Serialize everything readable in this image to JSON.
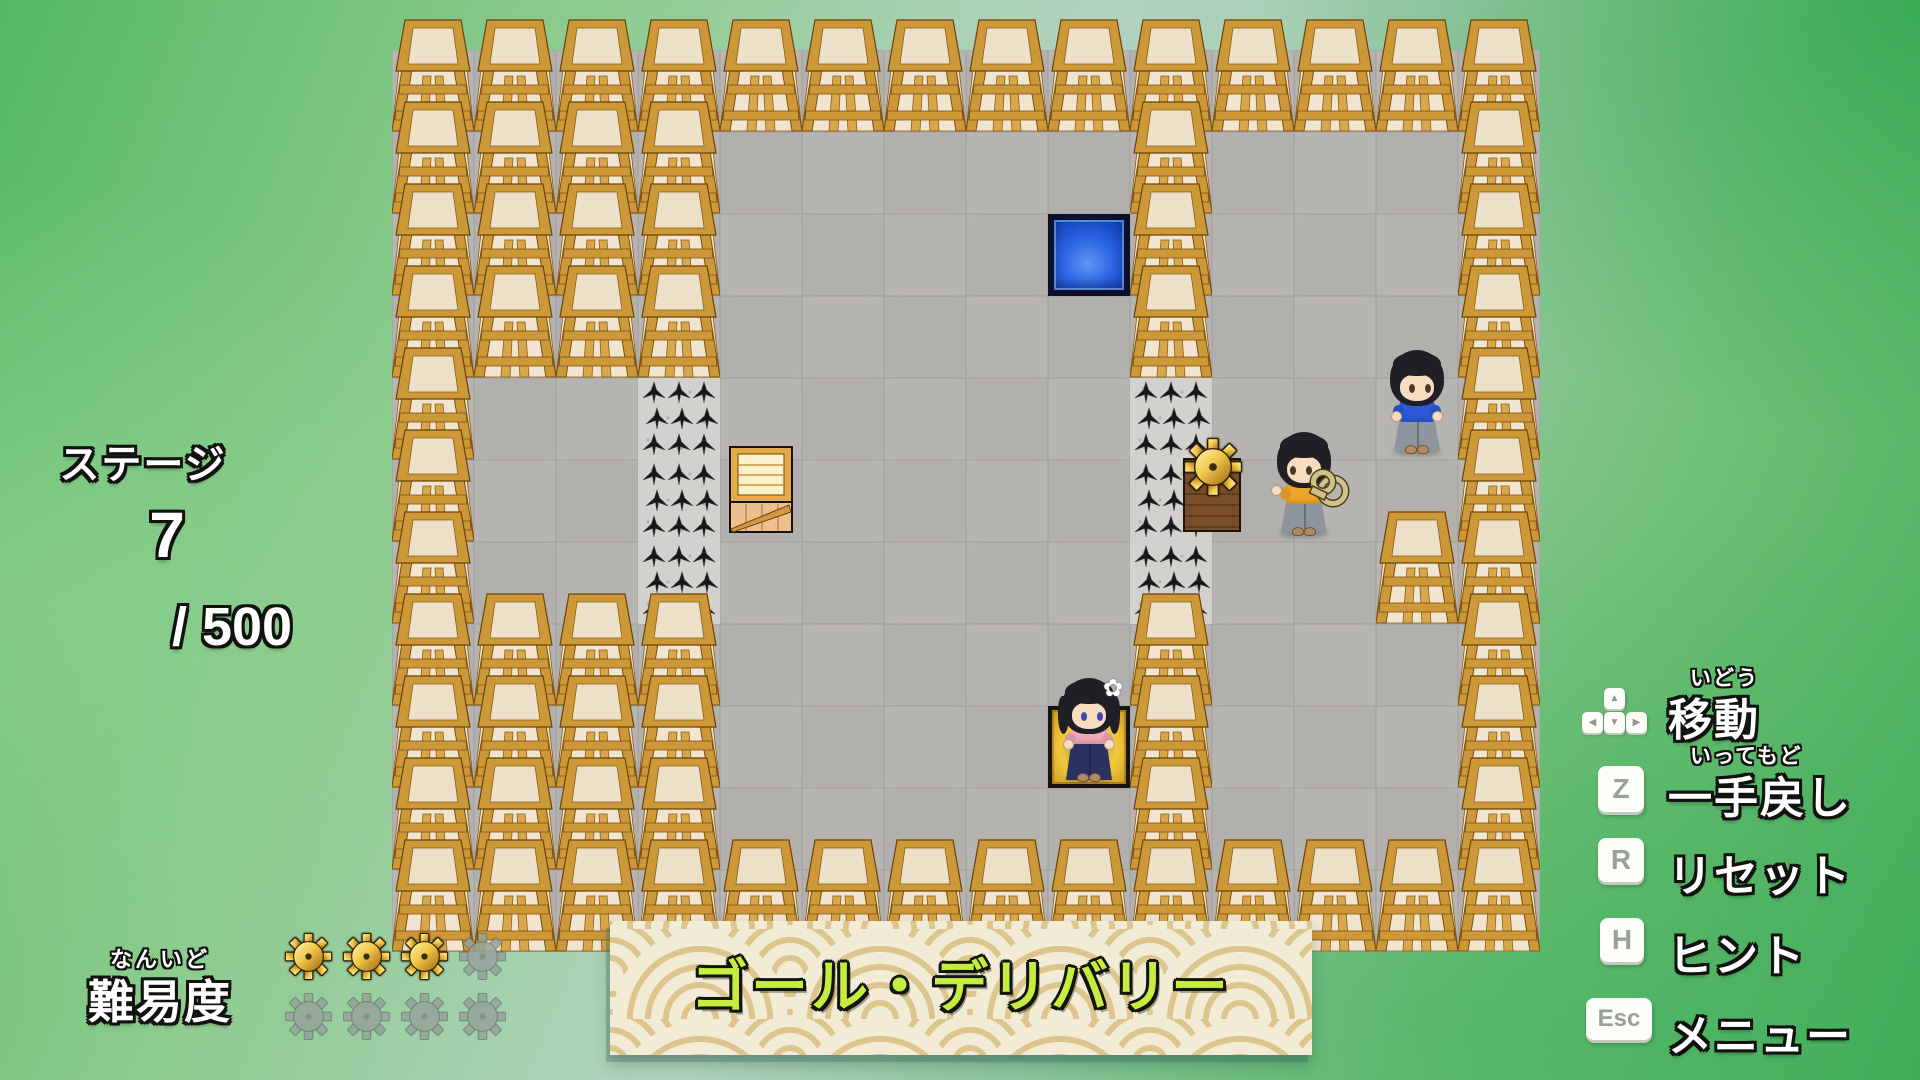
{
  "hud": {
    "stage": {
      "label": "ステージ",
      "number": "7",
      "total": "/ 500"
    },
    "difficulty": {
      "furigana": "なんいど",
      "label": "難易度",
      "filled": 3,
      "total": 8
    },
    "banner": {
      "title": "ゴール・デリバリー"
    }
  },
  "controls": {
    "move": {
      "furigana": "いどう",
      "label": "移動",
      "keys": [
        "▲",
        "◀",
        "▼",
        "▶"
      ]
    },
    "undo": {
      "furigana": "いってもど",
      "label": "一手戻し",
      "key": "Z"
    },
    "reset": {
      "label": "リセット",
      "key": "R"
    },
    "hint": {
      "label": "ヒント",
      "key": "H"
    },
    "menu": {
      "label": "メニュー",
      "key": "Esc"
    }
  },
  "board": {
    "origin_x": 392,
    "origin_y": 50,
    "tile": 82,
    "cols": 14,
    "rows": 11,
    "legend": {
      "W": "wall-block",
      "S": "spike-tile",
      ".": "stone-floor",
      "B": "blue-goal-tile",
      "G": "gold-goal-tile"
    },
    "map": [
      "WWWWWWWWWWWWWW",
      "WWWW.....W...W",
      "WWWW....BW...W",
      "WWWW.....W...W",
      "W..S.....S...W",
      "W..S.....S...W",
      "W..S.....S..WW",
      "WWWW.....W...W",
      "WWWW....GW...W",
      "WWWW.....W...W",
      "WWWWWWWWWWWWWW"
    ],
    "entities": [
      {
        "type": "crate",
        "name": "wooden-crate",
        "col": 4,
        "row": 5
      },
      {
        "type": "gear",
        "name": "gear-on-pedestal",
        "col": 10,
        "row": 5
      },
      {
        "type": "character",
        "name": "boy-with-windup-key",
        "col": 10.62,
        "row": 5,
        "shirt": "#f0a42c",
        "skirt": "#8f959e",
        "facing": "left",
        "accessory": "windup-key"
      },
      {
        "type": "character",
        "name": "boy-in-blue",
        "col": 12,
        "row": 4,
        "shirt": "#2b59d8",
        "skirt": "#8f959e"
      },
      {
        "type": "character",
        "name": "flower-girl",
        "col": 8,
        "row": 8,
        "shirt": "#f2a8b8",
        "skirt": "#2b3160",
        "girl": true,
        "accessory": "flower",
        "flower_glyph": "✿"
      }
    ]
  },
  "colors": {
    "banner_text": "#c6ec40",
    "blue_tile": "#2a64e4",
    "gold_tile": "#f2c63c",
    "wood": "#cd9838",
    "floor": "#b6b4b1",
    "gear_gold": "#f0c84a",
    "gear_gray": "#96a39b"
  }
}
